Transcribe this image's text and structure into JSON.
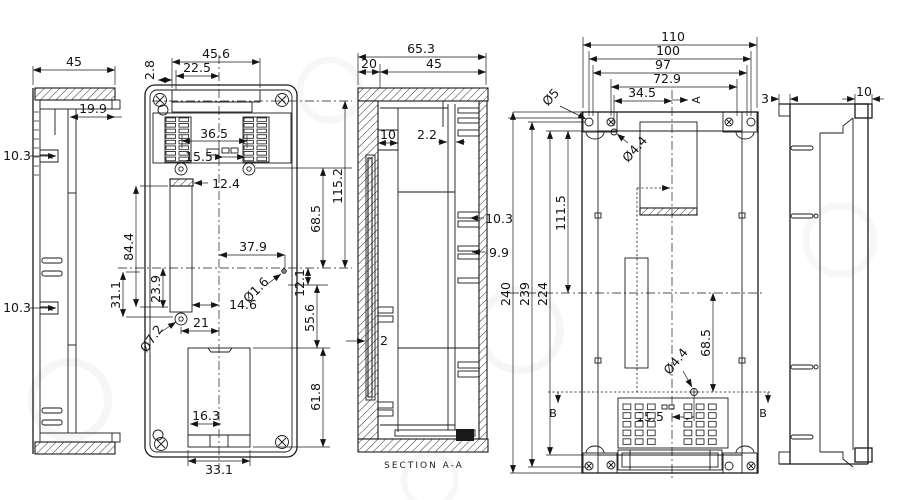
{
  "drawing": {
    "background": "#ffffff",
    "line_color": "#1a1a1a",
    "left_side_view": {
      "overall_width": "45",
      "flange_depth": "19.9",
      "upper_rib": "10.3",
      "lower_rib": "10.3"
    },
    "front_view": {
      "slot_width": "45.6",
      "slot_half": "22.5",
      "slot_edge_gap": "2.8",
      "dip_span": "36.5",
      "dip_offset": "15.5",
      "tab_width": "12.4",
      "slot_height": "84.4",
      "slot_lower": "31.1",
      "slot_mid": "23.9",
      "hole_offset_x": "37.9",
      "hole_dia": "Ø1.6",
      "hole_offset_y": "14.6",
      "screw_offset": "21",
      "screw_dia": "Ø7.2",
      "battery_tab": "16.3",
      "battery_width": "33.1",
      "total_height": "115.2",
      "upper_height": "68.5",
      "center_gap": "12.1",
      "lower_height": "55.6",
      "battery_height": "61.8"
    },
    "section_view": {
      "overall_width": "65.3",
      "wall_width": "20",
      "inner_width": "45",
      "lip_depth": "10",
      "panel_gap": "2.2",
      "rib_upper": "10.3",
      "rib_lower": "9.9",
      "panel_thickness": "2",
      "label": "SECTION A-A"
    },
    "back_view": {
      "overall_width": "110",
      "mount_width": "100",
      "hole_span": "97",
      "inner_span": "72.9",
      "hole_offset_x": "34.5",
      "ear_hole_dia": "Ø5",
      "aux_hole_dia": "Ø4.4",
      "overall_height": "240",
      "mount_height": "239",
      "inner_height": "224",
      "upper_height": "111.5",
      "lower_offset": "68.5",
      "bottom_hole_dia": "Ø4.4",
      "bottom_hole_offset": "15.5",
      "marker_a": "A",
      "marker_b_left": "B",
      "marker_b_right": "B"
    },
    "right_side_view": {
      "lip_width": "3",
      "step_width": "10"
    }
  }
}
